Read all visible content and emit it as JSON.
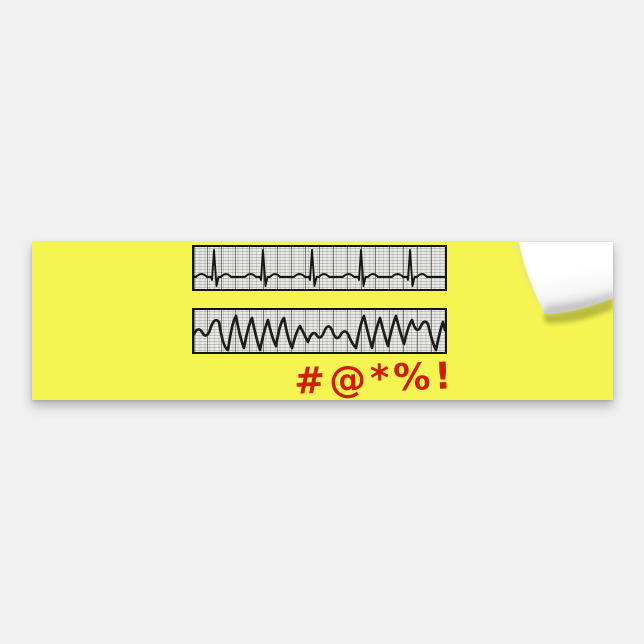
{
  "page": {
    "background_color": "#f0f0f0"
  },
  "product": {
    "kind": "bumper-sticker mockup with peeled top-right corner",
    "sticker_color": "#f5f452",
    "caption": "#@*%!",
    "caption_color": "#d11d04",
    "ecg_strips": [
      {
        "label": "normal-sinus-rhythm-strip",
        "paper_color": "#e8e8e6",
        "trace_color": "#161616",
        "beats": 5,
        "path": "M0,30 L2,30 Q7.5,24 13,30 L17,30 L18,33 L20,3 L22.5,39 L24.5,30 L27,30 Q32,24 37,30 L51,30 Q56.5,24 62,30 L66,30 L67,33 L69,3 L71.5,39 L73.5,30 L76,30 Q81,24 86,30 L100,30 Q105.5,24 111,30 L115,30 L116,33 L118,3 L120.5,39 L122.5,30 L125,30 Q130,24 135,30 L149,30 Q154.5,24 160,30 L164,30 L165,33 L167,3 L169.5,39 L171.5,30 L174,30 Q179,24 184,30 L198,30 Q203.5,24 209,30 L213,30 L214,33 L216,3 L218.5,39 L220.5,30 L223,30 Q228,24 233,30 L251,30"
      },
      {
        "label": "coarse-ventricular-fibrillation-strip",
        "paper_color": "#e8e8e6",
        "trace_color": "#1d1d1d",
        "path": "M0,24 Q4,16 8,22 Q12,30 16,20 Q20,6 25,12 Q29,38 34,40 Q38,12 42,6 Q46,28 50,38 Q54,16 58,8 Q62,28 66,40 Q70,20 74,10 Q78,28 82,36 Q86,12 90,8 Q94,30 98,38 Q102,22 106,16 Q110,24 114,32 Q118,20 122,24 Q126,32 130,22 Q134,12 138,20 Q142,32 146,26 Q150,18 154,24 Q158,34 162,38 Q166,14 170,6 Q174,24 178,38 Q182,18 186,8 Q190,24 194,36 Q198,16 202,6 Q206,22 210,34 Q214,16 218,10 Q222,24 226,18 Q230,8 234,14 Q238,32 242,40 Q246,20 249,12 Q250,16 251,20"
      }
    ],
    "peel_corner": {
      "flap_color": "#ffffff",
      "crease_color": "#b9b9b9",
      "cast_shadow_color": "#5f5f1e"
    }
  }
}
